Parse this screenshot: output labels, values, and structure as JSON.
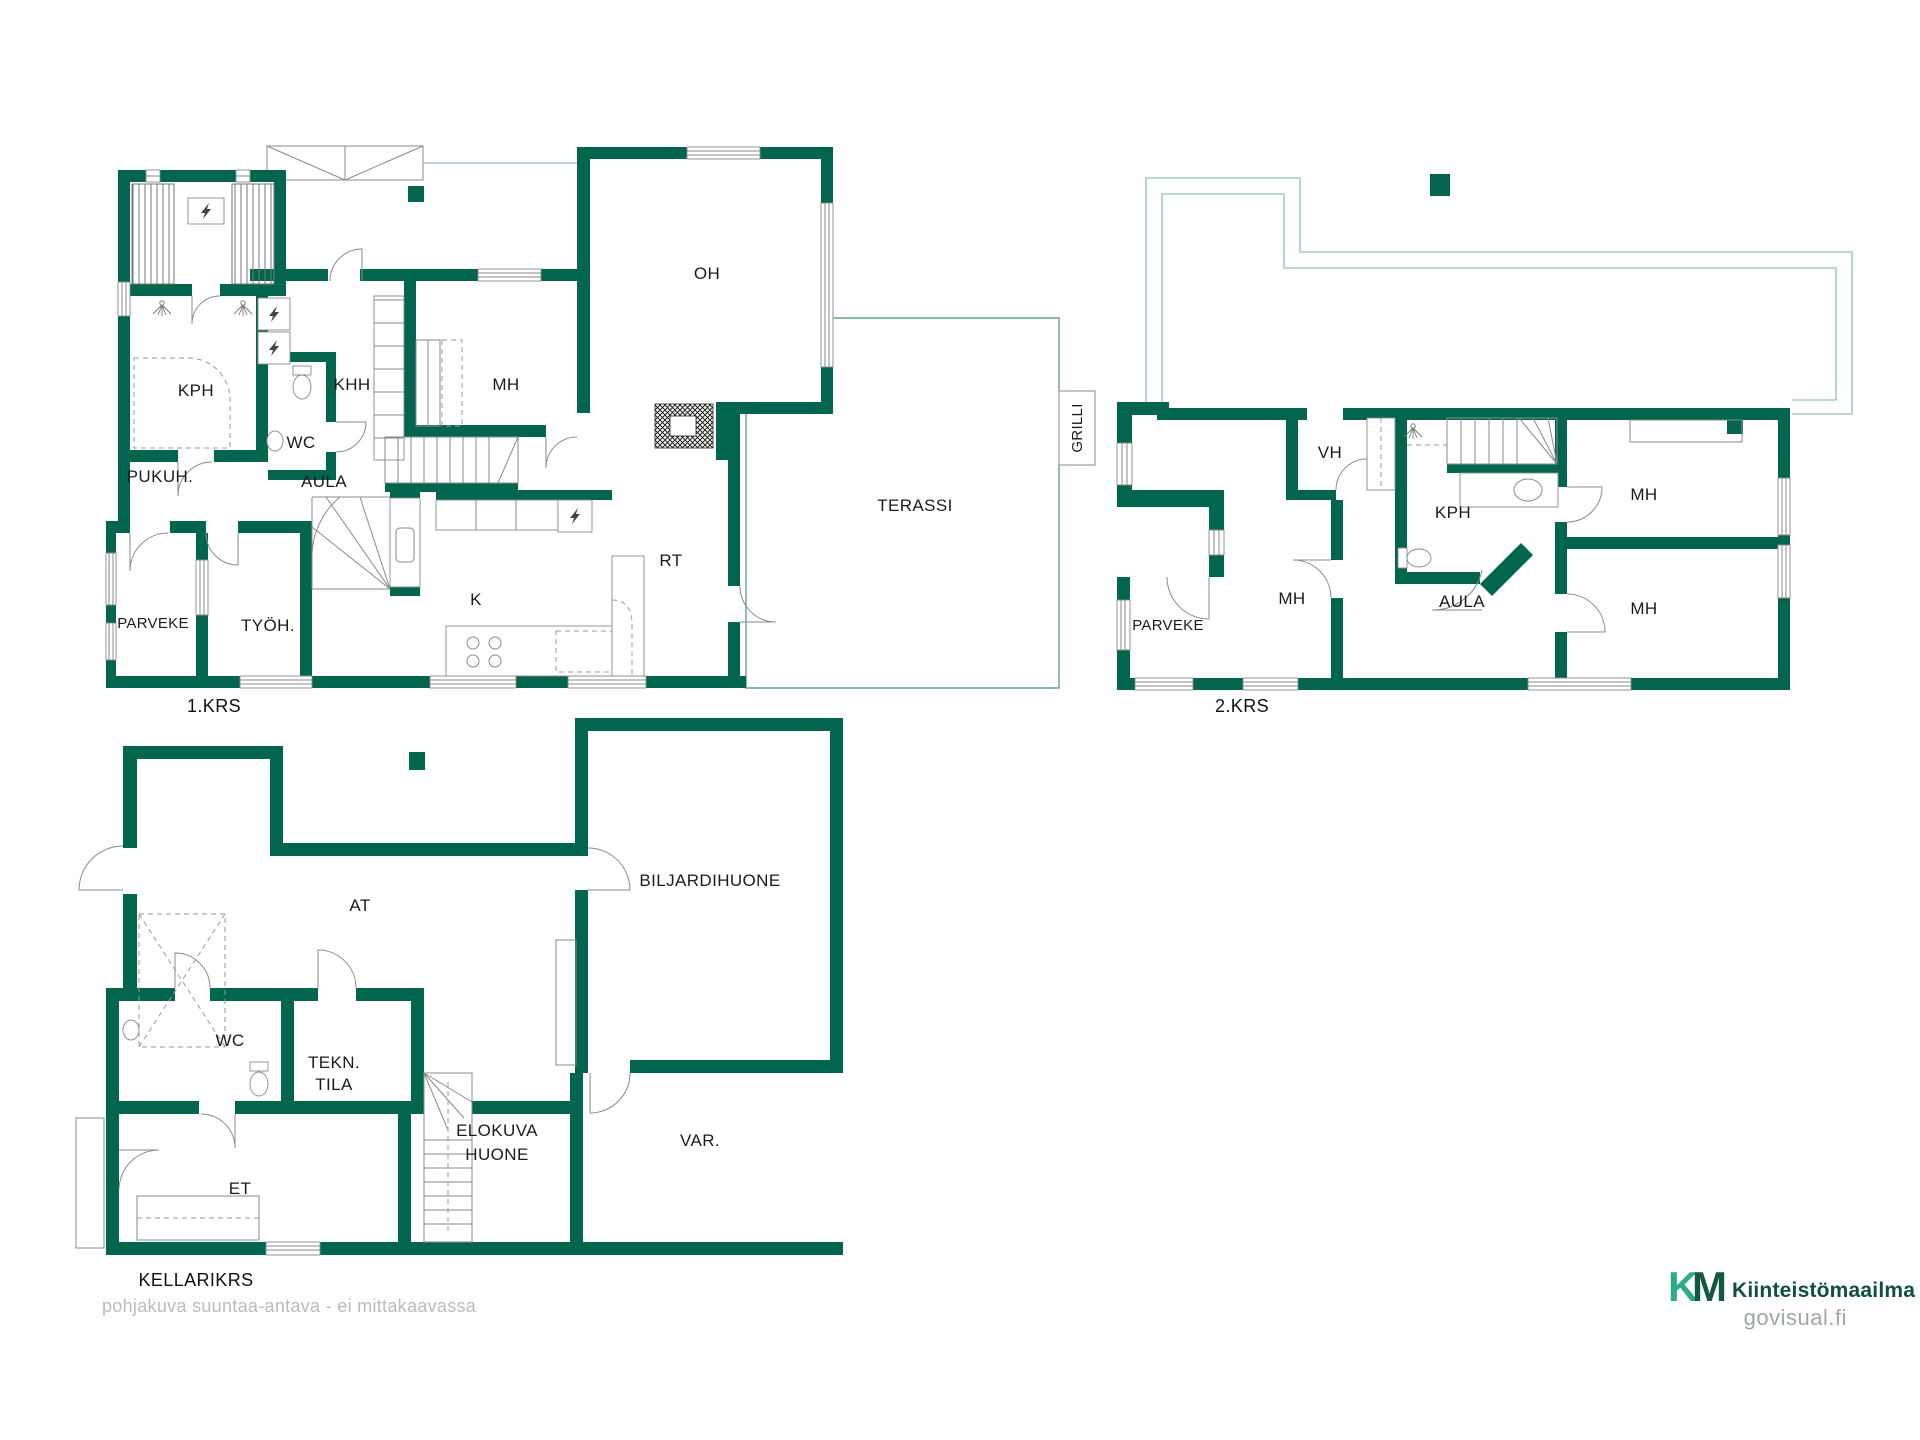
{
  "colors": {
    "wall": "#02664E",
    "roof_outline": "#A6CBC2",
    "terrace_outline": "#66A096",
    "logo_k": "#2EA98A",
    "logo_m": "#14593F",
    "logo_text": "#0F4F41",
    "footer_text": "#b9bcba",
    "website_text": "#9FA6A6"
  },
  "floors": [
    {
      "name": "1.KRS",
      "rooms": [
        {
          "label": "KPH"
        },
        {
          "label": "WC"
        },
        {
          "label": "KHH"
        },
        {
          "label": "MH"
        },
        {
          "label": "OH"
        },
        {
          "label": "PUKUH."
        },
        {
          "label": "AULA"
        },
        {
          "label": "TYÖH."
        },
        {
          "label": "K"
        },
        {
          "label": "RT"
        },
        {
          "label": "PARVEKE"
        },
        {
          "label": "TERASSI"
        },
        {
          "label": "GRILLI"
        }
      ]
    },
    {
      "name": "2.KRS",
      "rooms": [
        {
          "label": "VH"
        },
        {
          "label": "KPH"
        },
        {
          "label": "MH"
        },
        {
          "label": "MH"
        },
        {
          "label": "MH"
        },
        {
          "label": "AULA"
        },
        {
          "label": "PARVEKE"
        }
      ]
    },
    {
      "name": "KELLARIKRS",
      "rooms": [
        {
          "label": "AT"
        },
        {
          "label": "BILJARDIHUONE"
        },
        {
          "label": "WC"
        },
        {
          "label": "TEKN.",
          "label2": "TILA"
        },
        {
          "label": "ET"
        },
        {
          "label": "ELOKUVA",
          "label2": "HUONE"
        },
        {
          "label": "VAR."
        }
      ]
    }
  ],
  "footer": {
    "disclaimer": "pohjakuva suuntaa-antava - ei mittakaavassa"
  },
  "branding": {
    "mark_k": "K",
    "mark_m": "M",
    "company": "Kiinteistömaailma",
    "website": "govisual.fi"
  }
}
